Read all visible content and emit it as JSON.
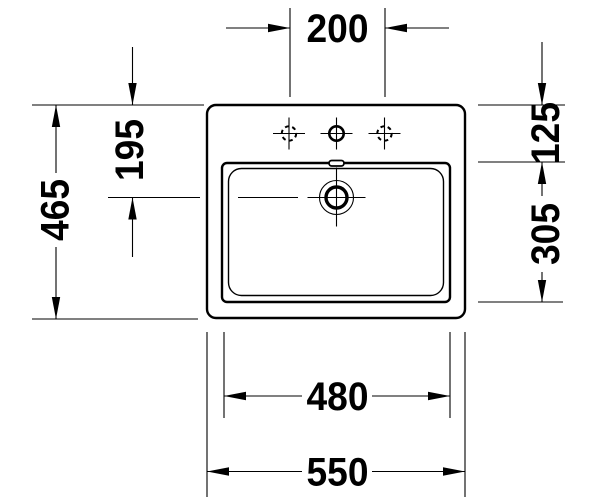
{
  "dims": {
    "tap_hole_spacing": "200",
    "total_depth": "465",
    "back_to_drain": "195",
    "back_to_bowl": "125",
    "bowl_depth": "305",
    "bowl_width": "480",
    "total_width": "550"
  },
  "features": {
    "tap_holes": [
      "optional-tap-hole-left",
      "tap-hole-center",
      "optional-tap-hole-right"
    ],
    "drain": "drain-with-centerlines",
    "overflow": "overflow-slot"
  },
  "colors": {
    "line": "#000000",
    "background": "#ffffff"
  }
}
